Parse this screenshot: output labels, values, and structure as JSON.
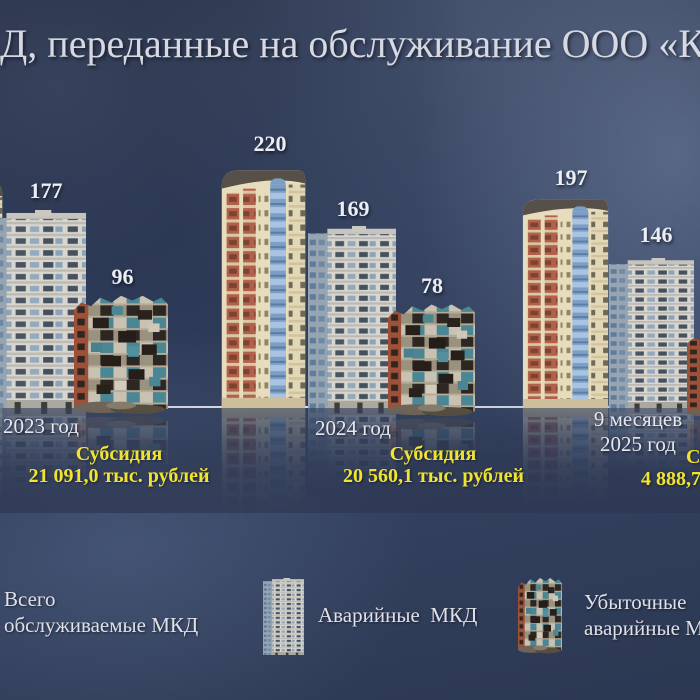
{
  "title": "Д, переданные на обслуживание ООО «Комф",
  "colors": {
    "background_navy": "#2c3650",
    "text_light": "#dfe0e8",
    "subsidy_yellow": "#f1e431",
    "baseline": "#e9edf5"
  },
  "chart_data": {
    "type": "bar",
    "title": "Д, переданные на обслуживание ООО «Комф",
    "categories": [
      "2023 год",
      "2024 год",
      "9 месяцев 2025 год"
    ],
    "series": [
      {
        "name": "Всего обслуживаемые МКД",
        "values": [
          177,
          220,
          197
        ]
      },
      {
        "name": "Аварийные МКД",
        "values": [
          null,
          169,
          146
        ]
      },
      {
        "name": "Убыточные аварийные МКД",
        "values": [
          96,
          78,
          null
        ]
      }
    ],
    "annotations": [
      {
        "category": "2023 год",
        "lines": [
          "Субсидия",
          "21 091,0 тыс. рублей"
        ]
      },
      {
        "category": "2024 год",
        "lines": [
          "Субсидия",
          "20 560,1 тыс. рублей"
        ]
      },
      {
        "category": "9 месяцев 2025 год",
        "lines": [
          "Су",
          "4 888,7"
        ]
      }
    ],
    "legend_position": "bottom",
    "presentation": "pictogram-buildings-on-baseline"
  },
  "groups": [
    {
      "period_lines": [
        "2023 год"
      ],
      "subsidy_label": "Субсидия",
      "subsidy_value": "21 091,0 тыс. рублей",
      "buildings": [
        {
          "value": "177",
          "icon": "panel-building"
        },
        {
          "value": "96",
          "icon": "ruined-building"
        }
      ]
    },
    {
      "period_lines": [
        "2024 год"
      ],
      "subsidy_label": "Субсидия",
      "subsidy_value": "20 560,1 тыс. рублей",
      "buildings": [
        {
          "value": "220",
          "icon": "tower-building"
        },
        {
          "value": "169",
          "icon": "panel-building"
        },
        {
          "value": "78",
          "icon": "ruined-building"
        }
      ]
    },
    {
      "period_lines": [
        "9 месяцев",
        "2025 год"
      ],
      "subsidy_label": "Су",
      "subsidy_value": "4 888,7",
      "buildings": [
        {
          "value": "197",
          "icon": "tower-building"
        },
        {
          "value": "146",
          "icon": "panel-building"
        }
      ]
    }
  ],
  "legend": [
    {
      "label_lines": [
        "Всего",
        "обслуживаемые МКД"
      ],
      "icon": "none"
    },
    {
      "label_lines": [
        "Аварийные  МКД"
      ],
      "icon": "panel-building"
    },
    {
      "label_lines": [
        "Убыточные",
        "аварийные МК"
      ],
      "icon": "ruined-building"
    }
  ]
}
